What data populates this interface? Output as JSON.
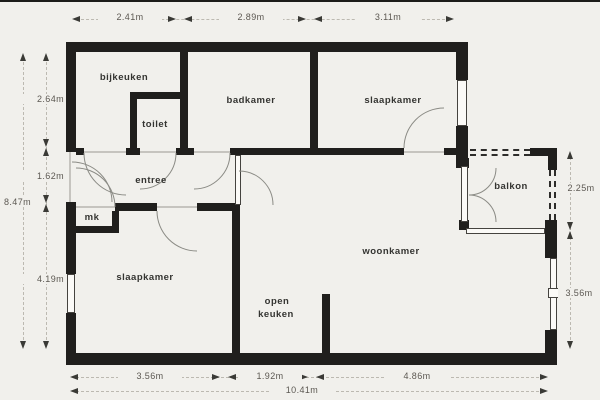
{
  "rooms": {
    "bijkeuken": "bijkeuken",
    "toilet": "toilet",
    "badkamer": "badkamer",
    "slaapkamer_top": "slaapkamer",
    "entree": "entree",
    "mk": "mk",
    "slaapkamer_bottom": "slaapkamer",
    "woonkamer": "woonkamer",
    "open_keuken_line1": "open",
    "open_keuken_line2": "keuken",
    "balkon": "balkon"
  },
  "dimensions": {
    "top": [
      "2.41m",
      "2.89m",
      "3.11m"
    ],
    "left": [
      "2.64m",
      "1.62m",
      "4.19m"
    ],
    "left_total": "8.47m",
    "right": [
      "2.25m",
      "3.56m"
    ],
    "bottom": [
      "3.56m",
      "1.92m",
      "4.86m"
    ],
    "bottom_total": "10.41m"
  },
  "colors": {
    "wall": "#201f1d",
    "background": "#f1f0ec",
    "window_fill": "#fbfaf7",
    "label_text": "#343431",
    "dimension_text": "#5c5852",
    "door_arc": "#8b8b85"
  }
}
